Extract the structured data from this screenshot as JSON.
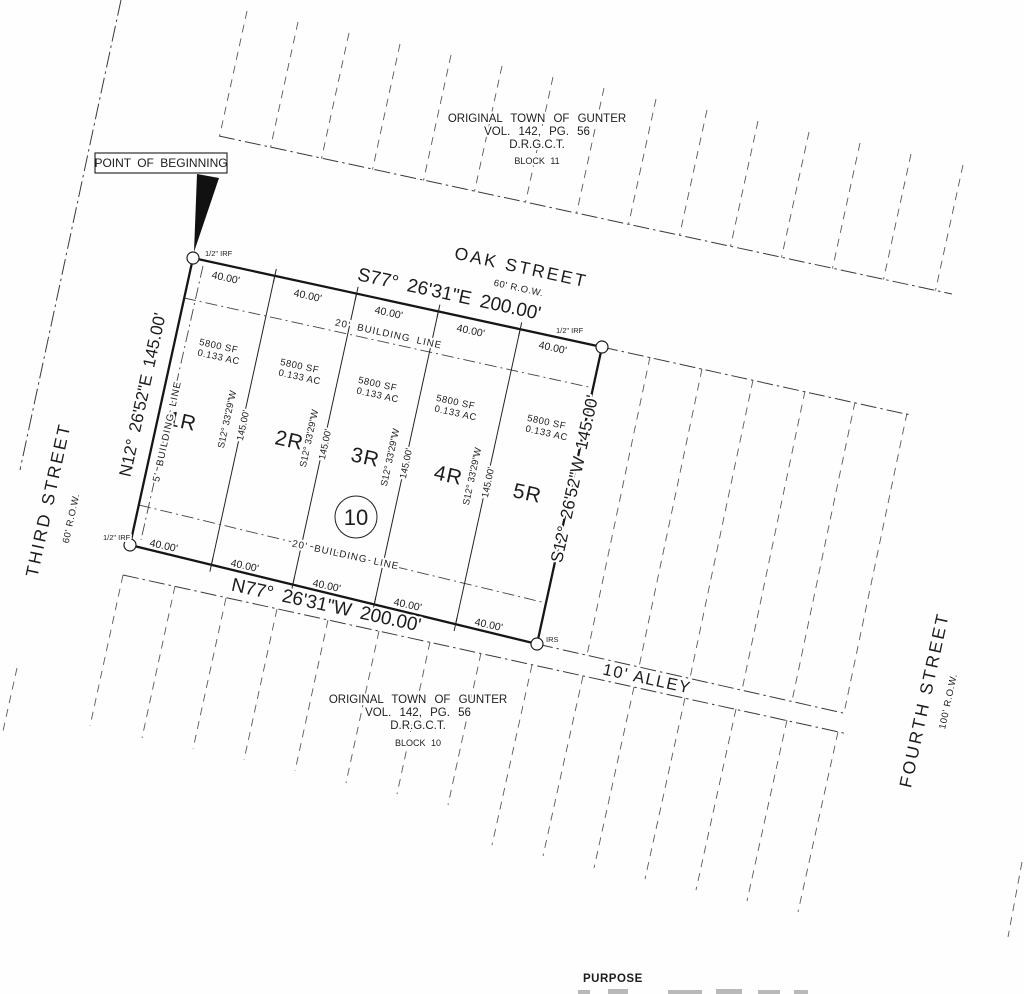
{
  "drawing": {
    "pob": "POINT OF BEGINNING",
    "purpose": "PURPOSE",
    "block11": {
      "line1": "ORIGINAL TOWN OF GUNTER",
      "line2": "VOL. 142, PG. 56",
      "line3": "D.R.G.C.T.",
      "line4": "BLOCK 11"
    },
    "block10": {
      "line1": "ORIGINAL TOWN OF GUNTER",
      "line2": "VOL. 142, PG. 56",
      "line3": "D.R.G.C.T.",
      "line4": "BLOCK 10"
    },
    "streets": {
      "oak": "OAK STREET",
      "oak_row": "60' R.O.W.",
      "third": "THIRD STREET",
      "third_row": "60' R.O.W.",
      "fourth": "FOURTH STREET",
      "fourth_row": "100' R.O.W.",
      "alley": "10' ALLEY"
    },
    "boundary": {
      "north": "S77° 26'31\"E  200.00'",
      "south": "N77° 26'31\"W  200.00'",
      "west": "N12° 26'52\"E  145.00'",
      "east": "S12° 26'52\"W  145.00'"
    },
    "ticks": {
      "top": [
        "40.00'",
        "40.00'",
        "40.00'",
        "40.00'",
        "40.00'"
      ],
      "bottom": [
        "40.00'",
        "40.00'",
        "40.00'",
        "40.00'",
        "40.00'"
      ]
    },
    "interior": [
      {
        "bearing": "S12° 33'29\"W",
        "distance": "145.00'"
      },
      {
        "bearing": "S12° 33'29\"W",
        "distance": "145.00'"
      },
      {
        "bearing": "S12° 33'29\"W",
        "distance": "145.00'"
      },
      {
        "bearing": "S12° 33'29\"W",
        "distance": "145.00'"
      }
    ],
    "lots": [
      {
        "id": "1R",
        "sf": "5800 SF",
        "ac": "0.133 AC"
      },
      {
        "id": "2R",
        "sf": "5800 SF",
        "ac": "0.133 AC"
      },
      {
        "id": "3R",
        "sf": "5800 SF",
        "ac": "0.133 AC"
      },
      {
        "id": "4R",
        "sf": "5800 SF",
        "ac": "0.133 AC"
      },
      {
        "id": "5R",
        "sf": "5800 SF",
        "ac": "0.133 AC"
      }
    ],
    "building": {
      "front": "20' BUILDING LINE",
      "rear": "20' BUILDING LINE",
      "side": "5' BUILDING LINE"
    },
    "markers": {
      "nw": "1/2\" IRF",
      "ne": "1/2\" IRF",
      "sw": "1/2\" IRF",
      "se": "IRS"
    },
    "block_circle": "10",
    "ink_color": "#1c1c1c"
  }
}
